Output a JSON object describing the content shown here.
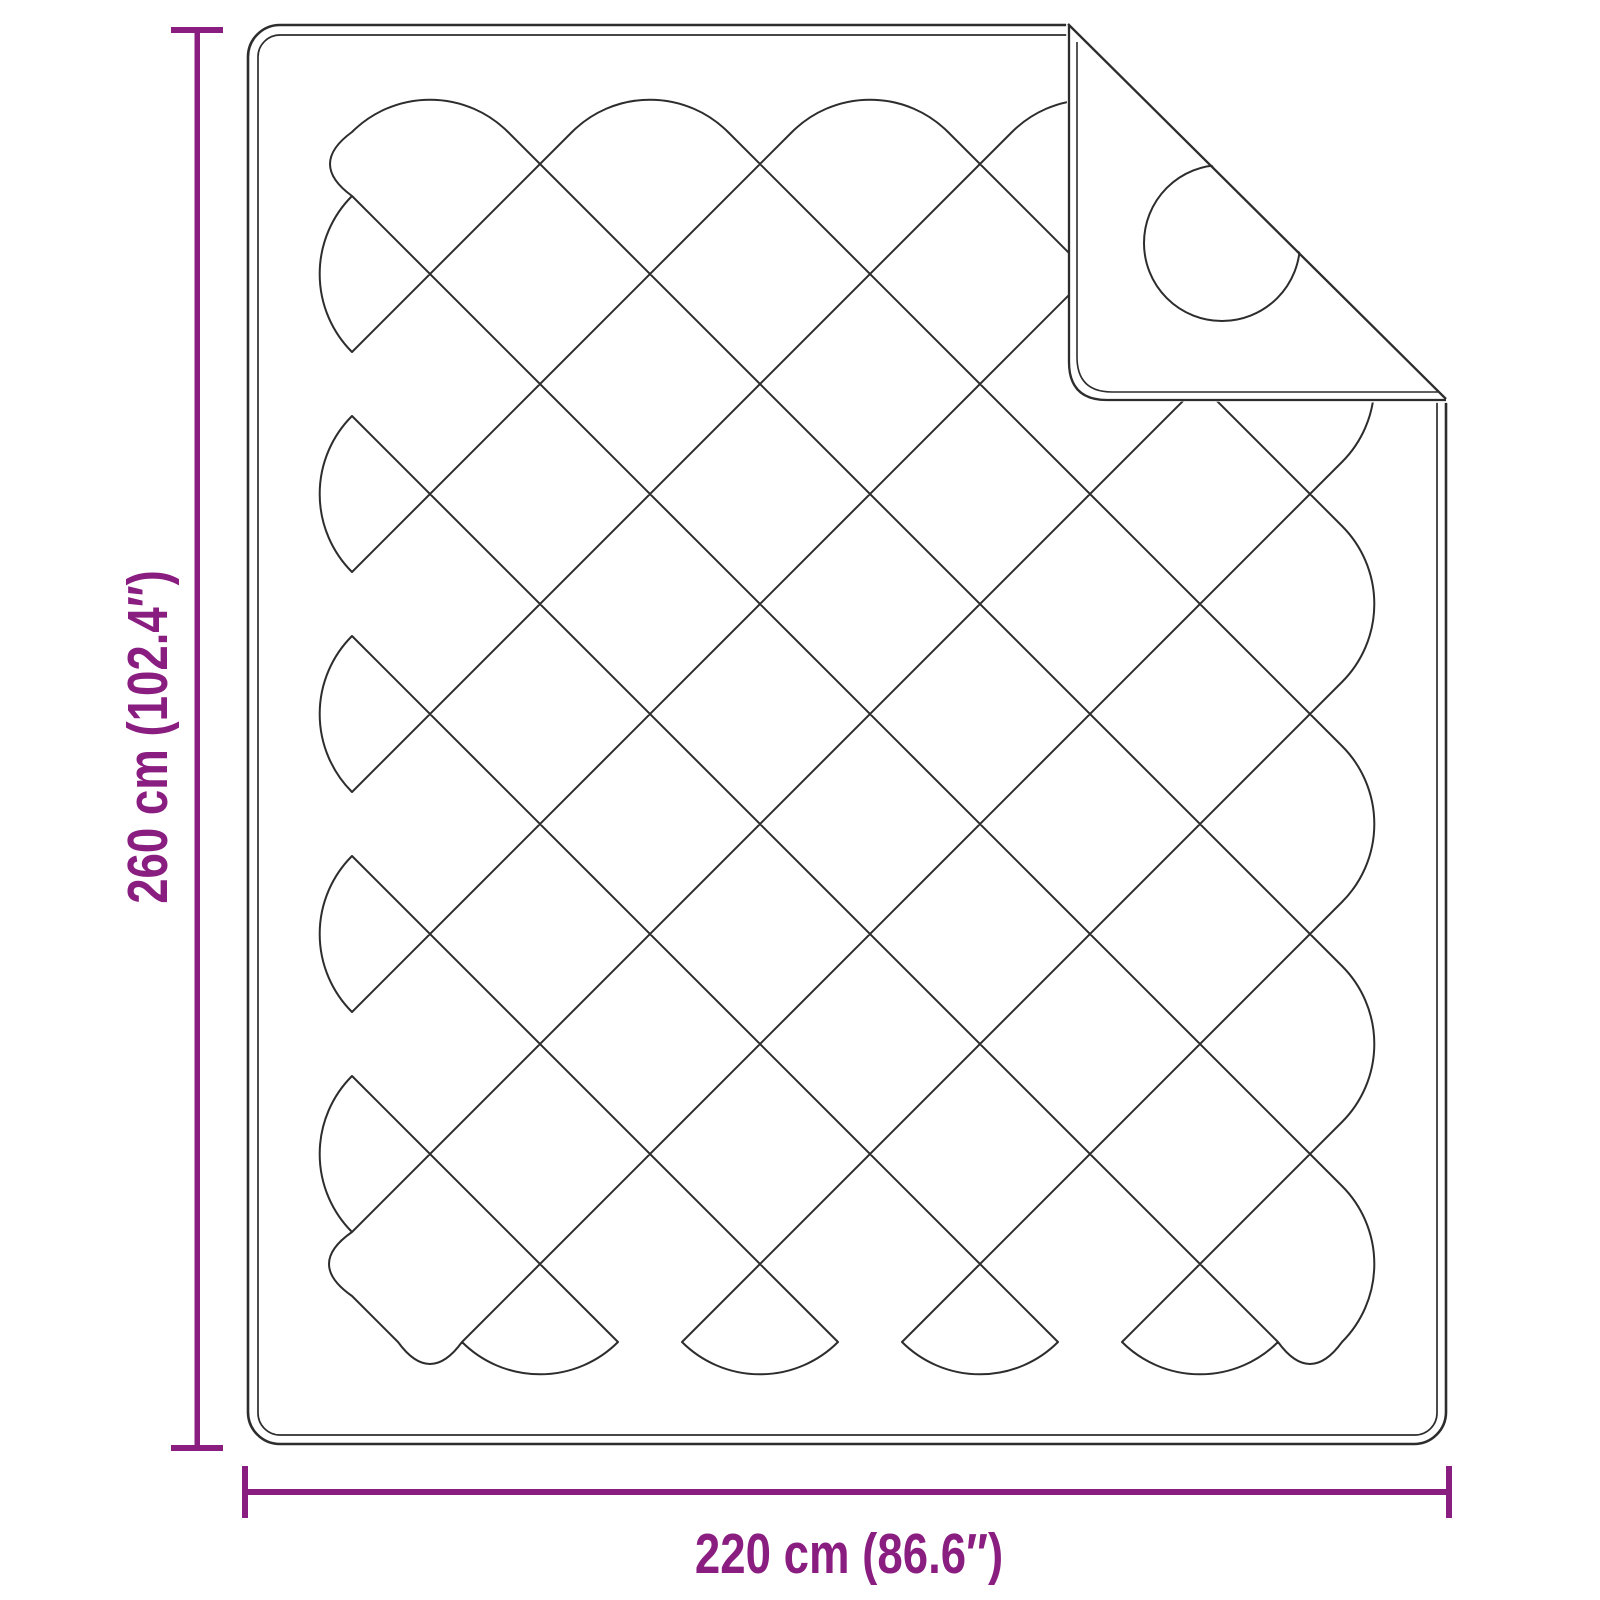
{
  "diagram": {
    "accent_color": "#8A1E80",
    "outline_color": "#2D2D2D",
    "background_color": "#FFFFFF",
    "height_dimension": {
      "label": "260 cm (102.4″)"
    },
    "width_dimension": {
      "label": "220 cm (86.6″)"
    }
  }
}
